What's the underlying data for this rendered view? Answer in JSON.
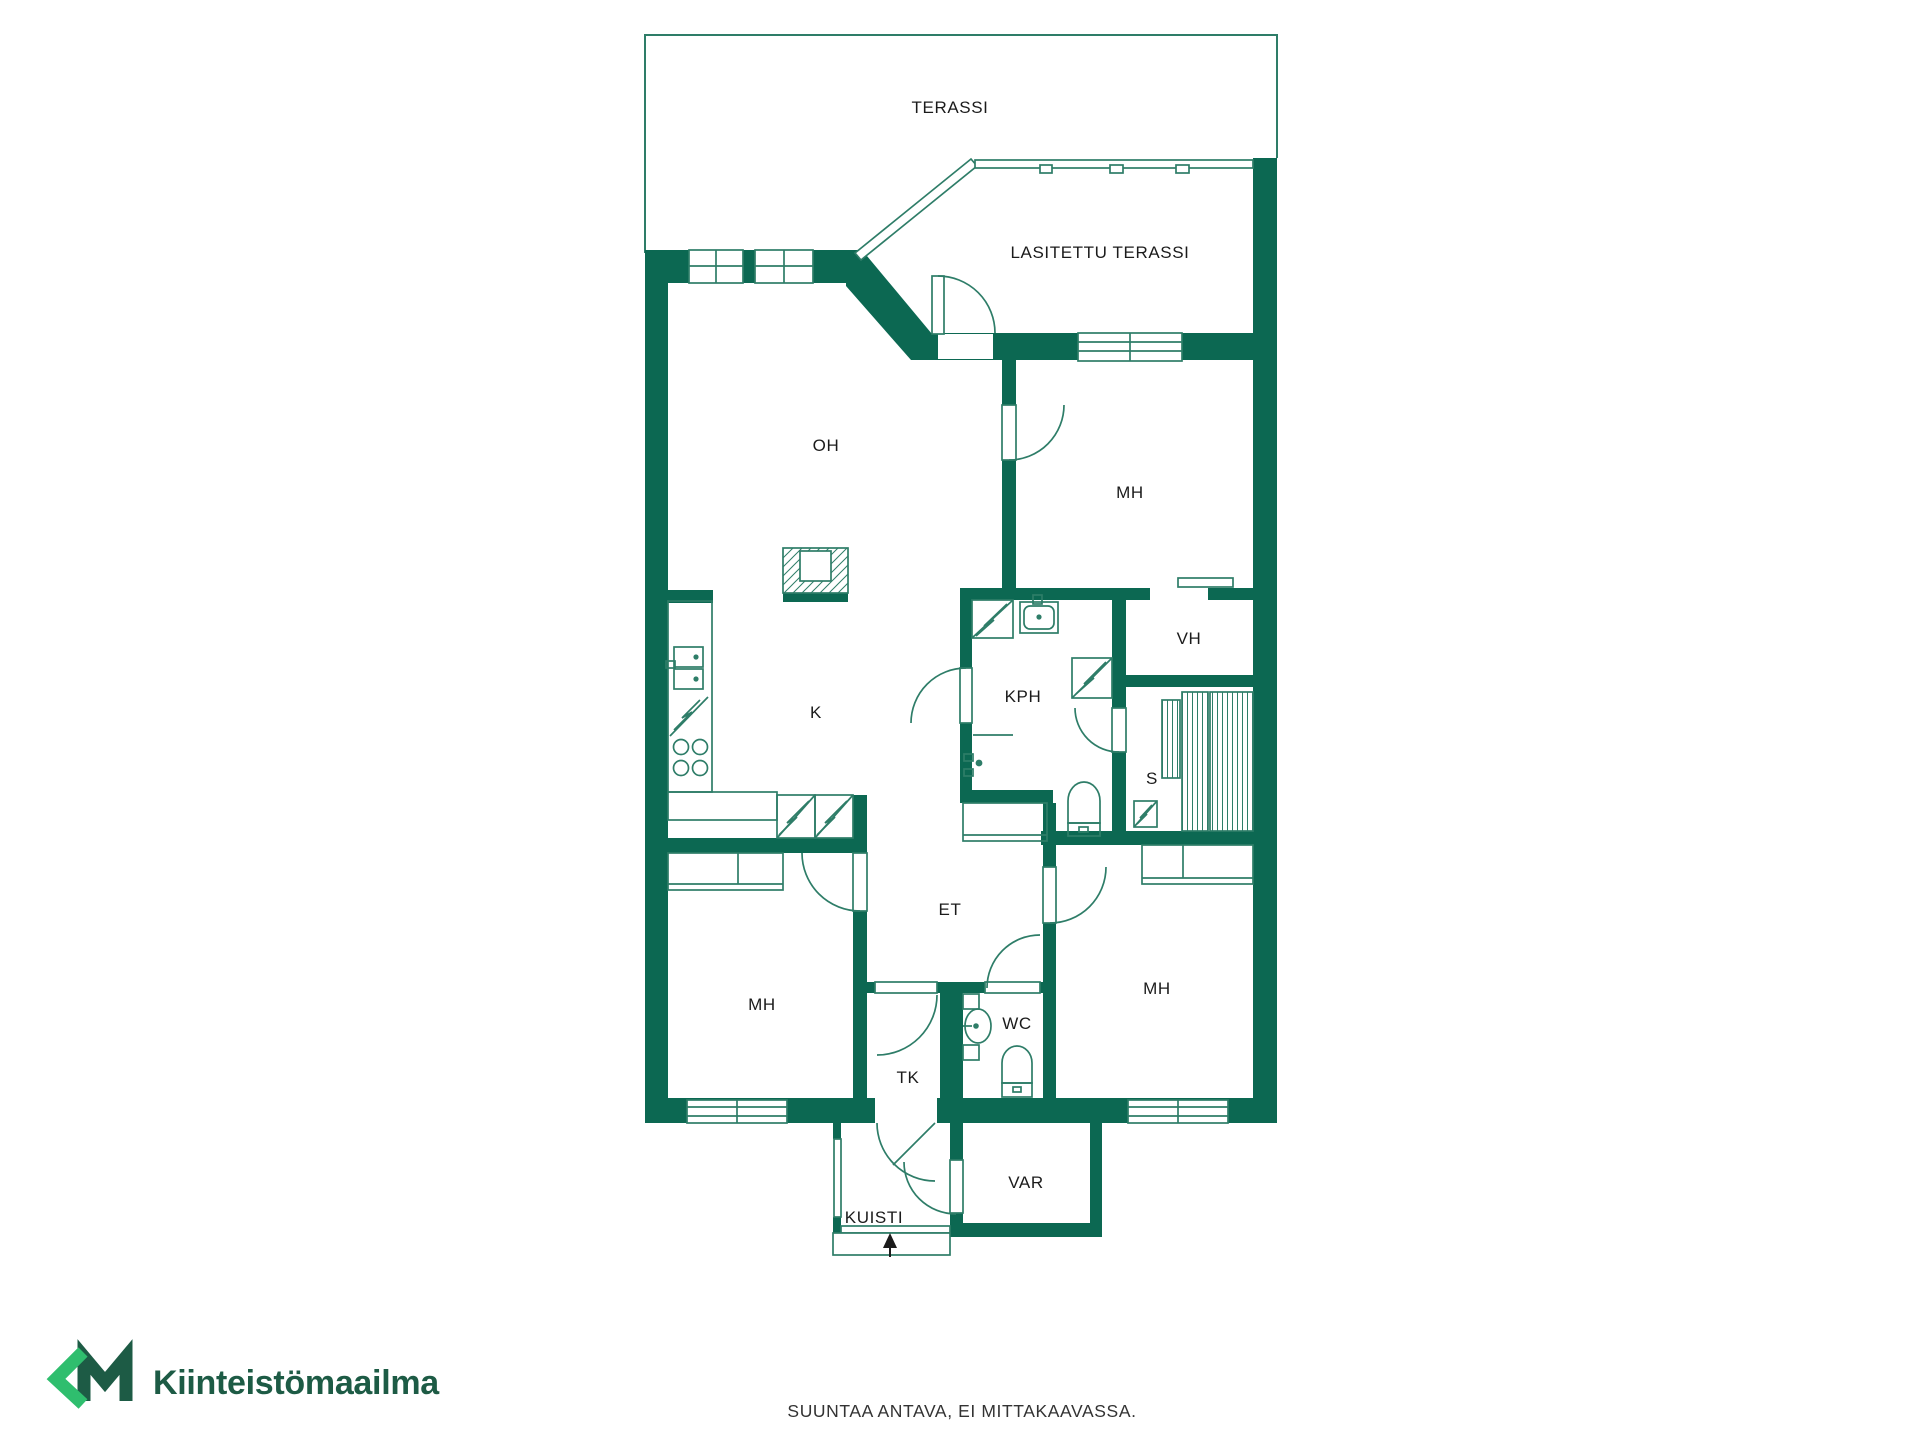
{
  "rooms": [
    {
      "id": "terassi",
      "label": "TERASSI"
    },
    {
      "id": "lasitettu-terassi",
      "label": "LASITETTU TERASSI"
    },
    {
      "id": "oh",
      "label": "OH"
    },
    {
      "id": "mh-top",
      "label": "MH"
    },
    {
      "id": "vh",
      "label": "VH"
    },
    {
      "id": "kph",
      "label": "KPH"
    },
    {
      "id": "s",
      "label": "S"
    },
    {
      "id": "k",
      "label": "K"
    },
    {
      "id": "et",
      "label": "ET"
    },
    {
      "id": "mh-left",
      "label": "MH"
    },
    {
      "id": "tk",
      "label": "TK"
    },
    {
      "id": "wc",
      "label": "WC"
    },
    {
      "id": "mh-right",
      "label": "MH"
    },
    {
      "id": "var",
      "label": "VAR"
    },
    {
      "id": "kuisti",
      "label": "KUISTI"
    }
  ],
  "footer": {
    "disclaimer": "SUUNTAA ANTAVA, EI MITTAKAAVASSA."
  },
  "brand": {
    "mark": "KM",
    "name": "Kiinteistömaailma"
  },
  "colors": {
    "wall": "#0c6852",
    "line": "#2e7d68",
    "text": "#1b1b1b",
    "brand_light": "#2fbe6e",
    "brand_dark": "#1d5b45",
    "disclaimer": "#333333"
  }
}
